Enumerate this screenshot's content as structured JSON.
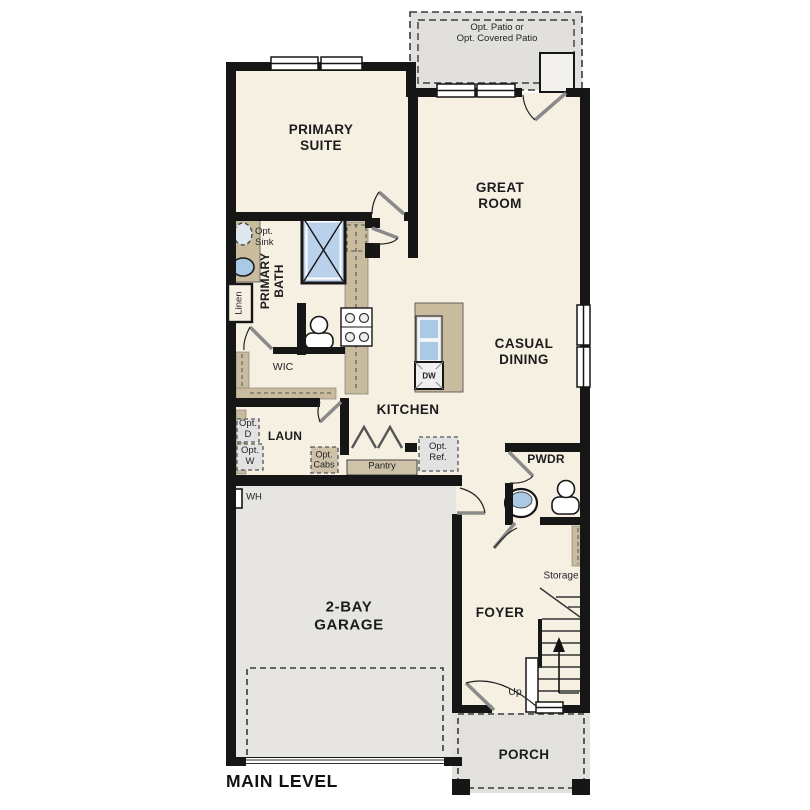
{
  "title": "MAIN LEVEL",
  "colors": {
    "wall": "#161616",
    "floor": "#f6f0e3",
    "garage_floor": "#e6e5e2",
    "patio_floor": "#e1e0dd",
    "porch_floor": "#e2e1dd",
    "cabinet_tan": "#c8bb9e",
    "pantry_tan": "#cec2a8",
    "fixture_blue": "#aac9e5",
    "shower_blue": "#b9d1ea"
  },
  "labels": {
    "patio": "Opt. Patio or\nOpt. Covered Patio",
    "primary_suite": "PRIMARY\nSUITE",
    "great_room": "GREAT\nROOM",
    "opt_sink": "Opt.\nSink",
    "primary_bath": "PRIMARY\nBATH",
    "linen": "Linen",
    "wic": "WIC",
    "kitchen": "KITCHEN",
    "casual_dining": "CASUAL\nDINING",
    "laundry": "LAUN",
    "opt_dryer": "Opt.\nD",
    "opt_washer": "Opt.\nW",
    "opt_cabs": "Opt.\nCabs",
    "pantry": "Pantry",
    "opt_ref": "Opt.\nRef.",
    "powder": "PWDR",
    "water_heater": "WH",
    "garage": "2-BAY\nGARAGE",
    "foyer": "FOYER",
    "storage": "Storage",
    "up": "Up",
    "porch": "PORCH",
    "dishwasher": "DW",
    "main_level": "MAIN LEVEL"
  }
}
